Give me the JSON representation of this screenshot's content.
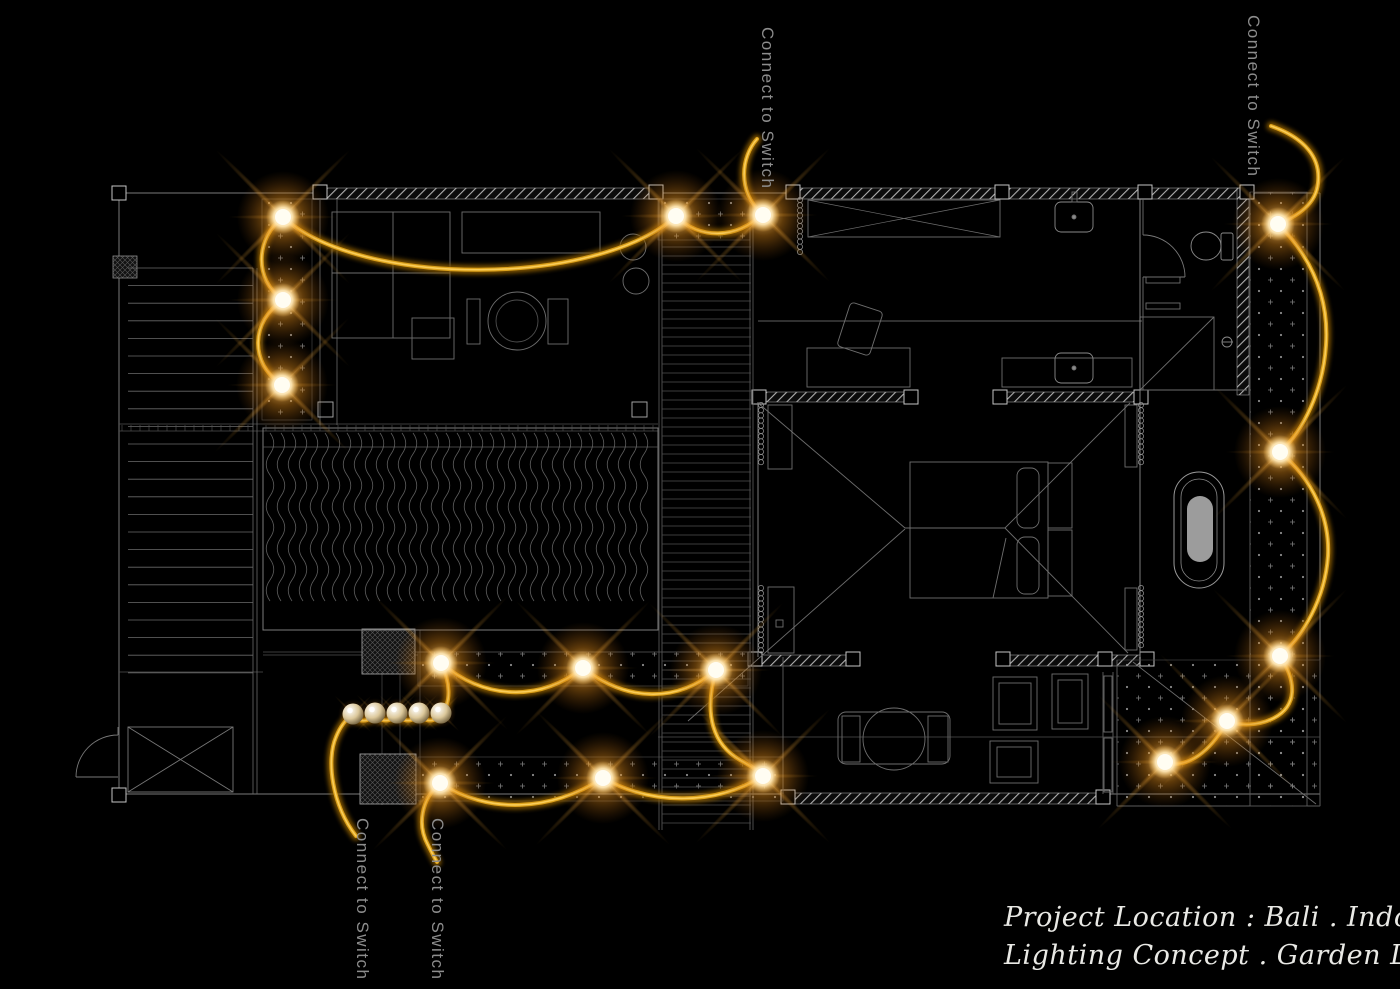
{
  "labels": {
    "connect_to_switch": "Connect to Switch"
  },
  "switch_labels": [
    {
      "id": "switch-label-top-center",
      "x": 757,
      "y": 27
    },
    {
      "id": "switch-label-top-right",
      "x": 1243,
      "y": 15
    },
    {
      "id": "switch-label-bottom-left-1",
      "x": 352,
      "y": 818
    },
    {
      "id": "switch-label-bottom-left-2",
      "x": 427,
      "y": 818
    }
  ],
  "title_block": {
    "line1": "Project Location : Bali . Indonesia",
    "line2": "Lighting Concept . Garden Light"
  },
  "colors": {
    "wire": "#dca11b",
    "wire_glow": "#8f5f00",
    "wire_highlight": "#ffd564",
    "bulb_core": "#fffdf2",
    "label_text": "#8d8d8d",
    "title_text": "#e9e9e5",
    "plan_line": "#9a9a9a"
  },
  "lights": {
    "strings": [
      {
        "name": "garden-string-top",
        "path": "M757,139 C741,157 737,191 762,214 C738,239 699,240 676,216 C598,287 360,288 283,217 C256,238 253,279 283,300 C251,321 249,363 282,385",
        "bulbs": [
          [
            763,
            215
          ],
          [
            676,
            216
          ],
          [
            283,
            217
          ],
          [
            283,
            300
          ],
          [
            282,
            385
          ]
        ],
        "pearls": []
      },
      {
        "name": "garden-string-right",
        "path": "M1271,126 C1305,138 1321,158 1318,183 C1316,204 1298,216 1278,224 C1313,259 1329,300 1326,345 C1323,391 1303,431 1280,452 C1313,480 1330,518 1328,556 C1325,599 1303,636 1280,656 C1297,682 1297,706 1274,718 C1258,726 1240,726 1227,721 C1213,748 1193,764 1174,764 C1170,764 1167,763 1165,762",
        "bulbs": [
          [
            1278,
            224
          ],
          [
            1280,
            452
          ],
          [
            1280,
            656
          ],
          [
            1227,
            721
          ],
          [
            1165,
            762
          ]
        ],
        "pearls": []
      },
      {
        "name": "garden-string-bottom",
        "path": "M356,836 C332,805 326,760 336,737 C340,727 346,719 353,714 C358,723 369,723 375,713 C380,723 392,723 397,713 C402,723 414,723 419,713 C424,723 436,723 441,713 C452,703 450,681 441,663 C485,700 539,702 583,668 C627,702 677,703 716,670 C703,716 714,745 740,760 C752,767 760,771 763,776 C716,805 653,806 603,778 C551,812 487,814 440,783 C421,800 417,825 428,845 C431,851 434,857 437,862",
        "bulbs": [
          [
            441,
            663
          ],
          [
            583,
            668
          ],
          [
            716,
            670
          ],
          [
            763,
            776
          ],
          [
            603,
            778
          ],
          [
            440,
            783
          ]
        ],
        "pearls": [
          [
            353,
            714
          ],
          [
            375,
            713
          ],
          [
            397,
            713
          ],
          [
            419,
            713
          ],
          [
            441,
            713
          ]
        ]
      }
    ]
  }
}
